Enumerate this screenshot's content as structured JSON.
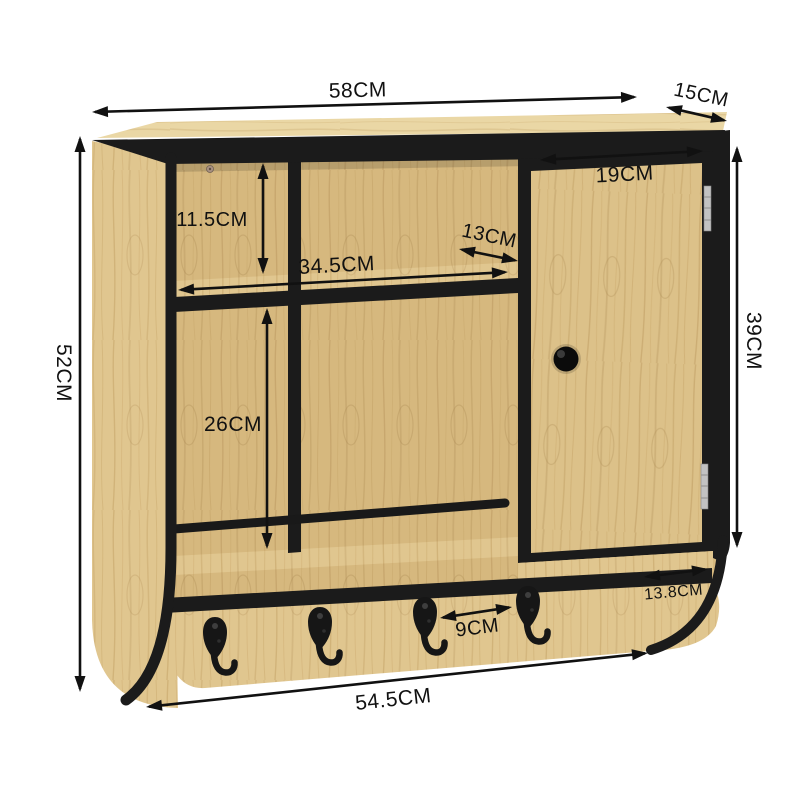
{
  "units": "CM",
  "colors": {
    "background": "#ffffff",
    "frame": "#1b1b1b",
    "wood_light": "#e0c68f",
    "wood_mid": "#d6b87e",
    "wood_top": "#ead7a5",
    "door_wood": "#dcc189",
    "grain": "#b5925a",
    "hinge": "#c2c2c2",
    "annotation": "#111111"
  },
  "dimensions": [
    {
      "id": "overall-width",
      "label": "58CM",
      "line": [
        92,
        112,
        637,
        97
      ],
      "label_pos": [
        358,
        97
      ],
      "rotate": -1.5,
      "size": 21
    },
    {
      "id": "depth",
      "label": "15CM",
      "line": [
        666,
        107,
        727,
        121
      ],
      "label_pos": [
        700,
        101
      ],
      "rotate": 12,
      "size": 20
    },
    {
      "id": "overall-height",
      "label": "52CM",
      "line": [
        80,
        136,
        80,
        692
      ],
      "label_pos": [
        57,
        373
      ],
      "rotate": 90,
      "size": 21
    },
    {
      "id": "upper-compartment-height",
      "label": "11.5CM",
      "line": [
        263,
        163,
        263,
        274
      ],
      "label_pos": [
        212,
        226
      ],
      "rotate": 0,
      "size": 20
    },
    {
      "id": "shelf-width",
      "label": "34.5CM",
      "line": [
        178,
        290,
        508,
        272
      ],
      "label_pos": [
        337,
        272
      ],
      "rotate": -3,
      "size": 21
    },
    {
      "id": "shelf-depth",
      "label": "13CM",
      "line": [
        459,
        249,
        518,
        261
      ],
      "label_pos": [
        488,
        242
      ],
      "rotate": 12,
      "size": 20
    },
    {
      "id": "lower-compartment-height",
      "label": "26CM",
      "line": [
        267,
        308,
        267,
        549
      ],
      "label_pos": [
        233,
        431
      ],
      "rotate": 0,
      "size": 21
    },
    {
      "id": "door-width",
      "label": "19CM",
      "line": [
        540,
        160,
        703,
        151
      ],
      "label_pos": [
        625,
        181
      ],
      "rotate": -3,
      "size": 21
    },
    {
      "id": "door-height",
      "label": "39CM",
      "line": [
        737,
        146,
        737,
        548
      ],
      "label_pos": [
        747,
        341
      ],
      "rotate": 90,
      "size": 21
    },
    {
      "id": "side-bottom-depth",
      "label": "13.8CM",
      "line": [
        644,
        577,
        708,
        569
      ],
      "label_pos": [
        674,
        597
      ],
      "rotate": -5,
      "size": 16
    },
    {
      "id": "hook-spacing",
      "label": "9CM",
      "line": [
        440,
        618,
        512,
        607
      ],
      "label_pos": [
        478,
        634
      ],
      "rotate": -7,
      "size": 20
    },
    {
      "id": "bottom-width",
      "label": "54.5CM",
      "line": [
        146,
        707,
        648,
        653
      ],
      "label_pos": [
        394,
        706
      ],
      "rotate": -6,
      "size": 21
    }
  ],
  "hooks": {
    "count": 4,
    "positions": [
      [
        215,
        617
      ],
      [
        320,
        607
      ],
      [
        425,
        597
      ],
      [
        528,
        586
      ]
    ]
  }
}
